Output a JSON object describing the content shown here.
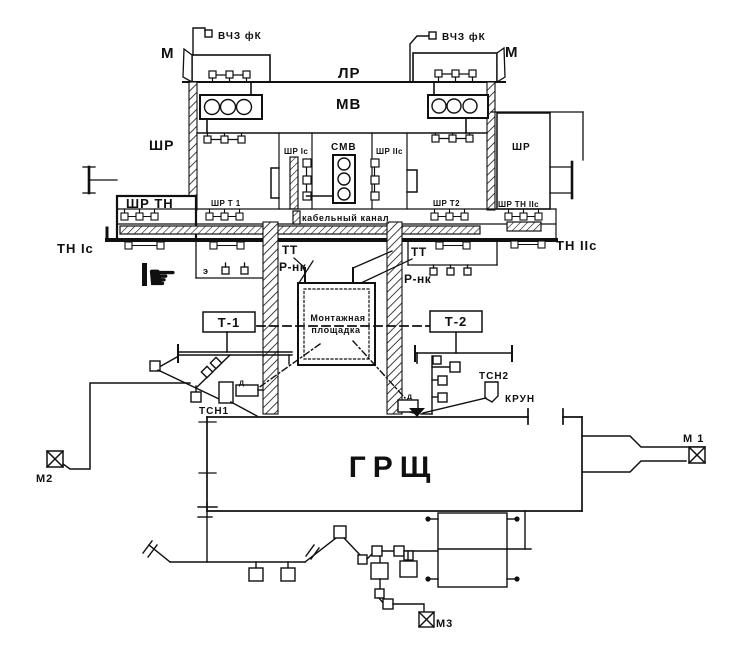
{
  "diagram": {
    "title_hint": "substation layout scheme",
    "colors": {
      "line": "#101010",
      "background": "#ffffff"
    },
    "labels": {
      "vchz_left": "ВЧЗ фК",
      "vchz_right": "ВЧЗ фК",
      "m_left": "М",
      "m_right": "М",
      "lr": "ЛР",
      "mv": "МВ",
      "shr_left": "ШР",
      "shr_right": "ШР",
      "shr_1s": "ШР Iс",
      "smv": "СМВ",
      "shr_2s": "ШР IIс",
      "shr_tn": "ШР ТН",
      "shr_t1": "ШР Т 1",
      "cable_channel": "кабельный канал",
      "shr_t2": "ШР Т2",
      "shr_tn_2s": "ШР ТН IIс",
      "tn_1s": "ТН Iс",
      "tn_2s": "ТН IIс",
      "tt_left": "ТТ",
      "rnk_left": "Р-нк",
      "tt_right": "ТТ",
      "rnk_right": "Р-нк",
      "e_small": "э",
      "t1": "Т-1",
      "t2": "Т-2",
      "montage_line1": "Монтажная",
      "montage_line2": "площадка",
      "tsn1": "ТСН1",
      "tsn2": "ТСН2",
      "krun": "КРУН",
      "d_left": "д",
      "d_right": "д",
      "grsh": "ГРЩ",
      "m1": "М 1",
      "m2": "М2",
      "m3": "М3"
    },
    "icons": {
      "hand_pointer": "☛"
    }
  }
}
